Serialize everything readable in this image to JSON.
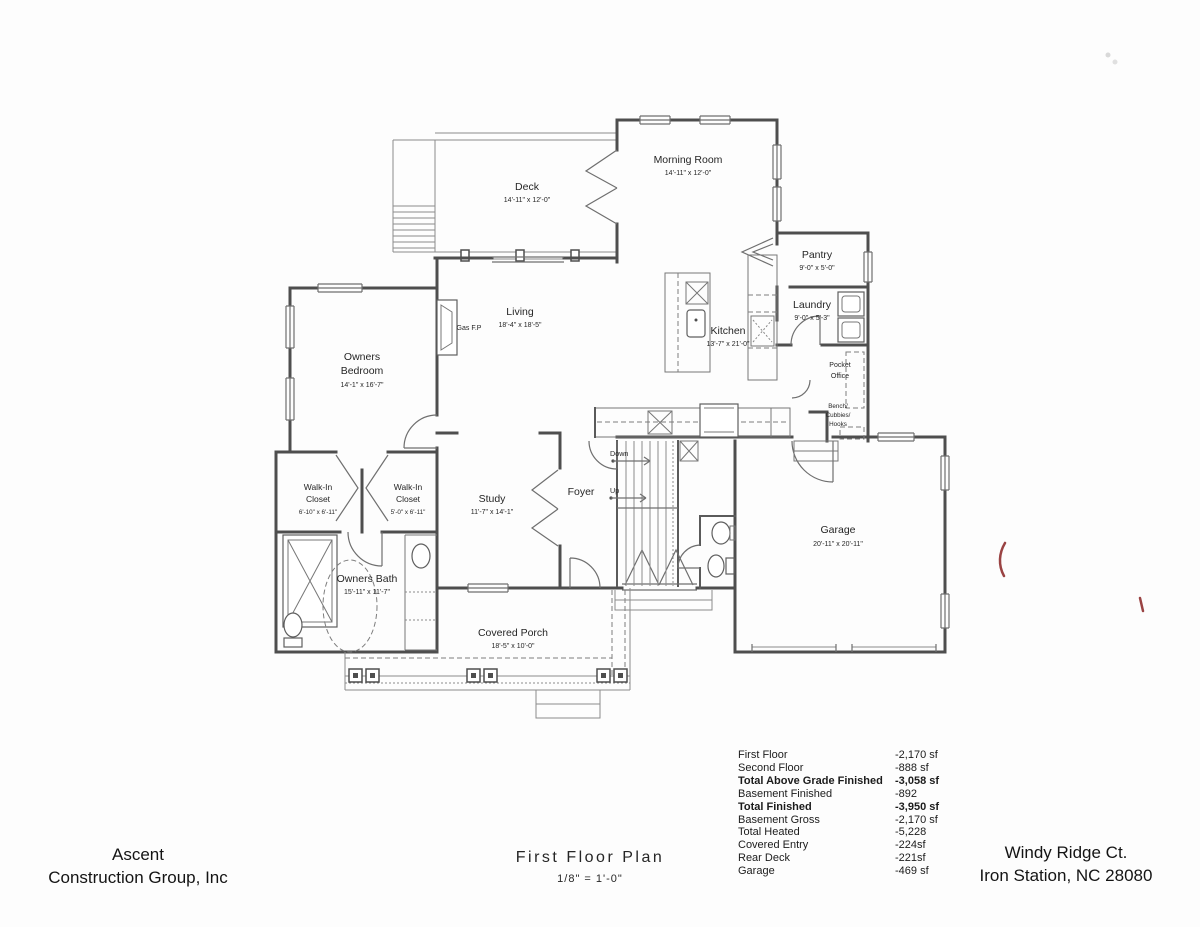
{
  "colors": {
    "artifact_red": "#9a4343",
    "ink": "#4e4e4e",
    "paper": "#fdfdfd"
  },
  "rooms": {
    "deck": {
      "name": "Deck",
      "dims": "14'-11\" x 12'-0\""
    },
    "morning_room": {
      "name": "Morning Room",
      "dims": "14'-11\" x 12'-0\""
    },
    "pantry": {
      "name": "Pantry",
      "dims": "9'-0\" x 5'-0\""
    },
    "laundry": {
      "name": "Laundry",
      "dims": "9'-0\" x 5'-3\""
    },
    "kitchen": {
      "name": "Kitchen",
      "dims": "13'-7\" x 21'-0\""
    },
    "living": {
      "name": "Living",
      "dims": "18'-4\" x 18'-5\""
    },
    "owners_bedroom": {
      "line1": "Owners",
      "line2": "Bedroom",
      "dims": "14'-1\" x 16'-7\""
    },
    "wic_left": {
      "line1": "Walk-In",
      "line2": "Closet",
      "dims": "6'-10\" x 6'-11\""
    },
    "wic_right": {
      "line1": "Walk-In",
      "line2": "Closet",
      "dims": "5'-0\" x 6'-11\""
    },
    "study": {
      "name": "Study",
      "dims": "11'-7\" x 14'-1\""
    },
    "foyer": {
      "name": "Foyer"
    },
    "garage": {
      "name": "Garage",
      "dims": "20'-11\" x 20'-11\""
    },
    "owners_bath": {
      "name": "Owners Bath",
      "dims": "15'-11\" x 11'-7\""
    },
    "covered_porch": {
      "name": "Covered Porch",
      "dims": "18'-5\" x 10'-0\""
    }
  },
  "annotations": {
    "gas_fp": "Gas F.P",
    "pocket_office_line1": "Pocket",
    "pocket_office_line2": "Office",
    "bench_line1": "Bench/",
    "bench_line2": "Cubbies/",
    "bench_line3": "Hooks",
    "stairs_down": "Down",
    "stairs_up": "Up"
  },
  "area_table": {
    "rows": [
      {
        "label": "First Floor",
        "value": "-2,170 sf"
      },
      {
        "label": "Second Floor",
        "value": "-888 sf"
      },
      {
        "label": "Total Above Grade Finished",
        "value": "-3,058 sf"
      },
      {
        "label": "Basement Finished",
        "value": "-892"
      },
      {
        "label": "Total Finished",
        "value": "-3,950 sf"
      },
      {
        "label": "Basement Gross",
        "value": "-2,170 sf"
      },
      {
        "label": "Total Heated",
        "value": "-5,228"
      },
      {
        "label": "Covered Entry",
        "value": "-224sf"
      },
      {
        "label": "Rear Deck",
        "value": "-221sf"
      },
      {
        "label": "Garage",
        "value": "-469 sf"
      }
    ]
  },
  "title_block": {
    "company_line1": "Ascent",
    "company_line2": "Construction Group, Inc",
    "plan_title": "First Floor Plan",
    "plan_scale": "1/8\" = 1'-0\"",
    "address_line1": "Windy Ridge Ct.",
    "address_line2": "Iron Station, NC 28080"
  }
}
